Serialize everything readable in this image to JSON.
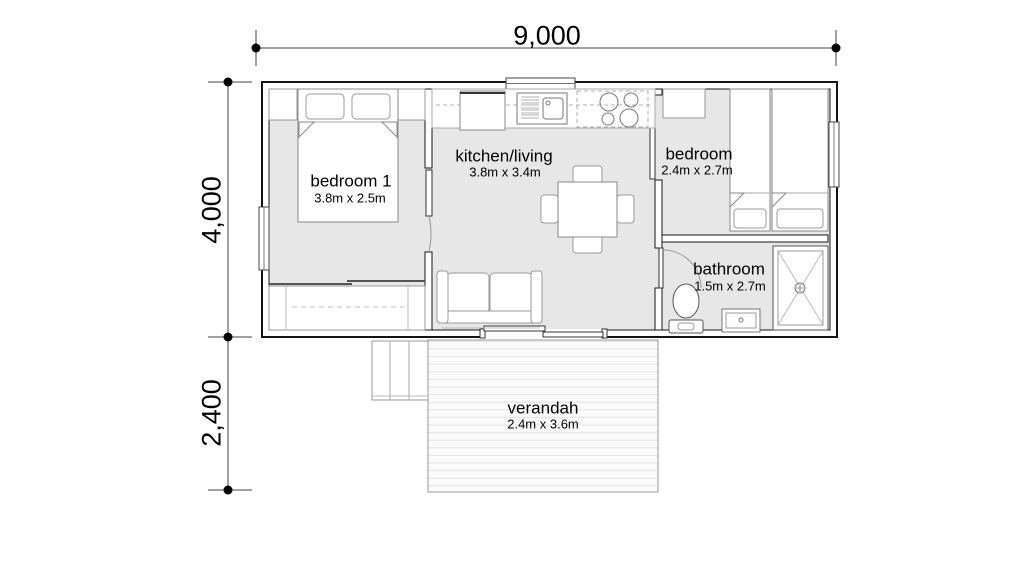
{
  "dimensions": {
    "width_total": "9,000",
    "height_main": "4,000",
    "height_verandah": "2,400"
  },
  "rooms": {
    "bedroom1": {
      "name": "bedroom 1",
      "size": "3.8m x 2.5m"
    },
    "kitchen_living": {
      "name": "kitchen/living",
      "size": "3.8m x 3.4m"
    },
    "bedroom2": {
      "name": "bedroom",
      "size": "2.4m x 2.7m"
    },
    "bathroom": {
      "name": "bathroom",
      "size": "1.5m x 2.7m"
    },
    "verandah": {
      "name": "verandah",
      "size": "2.4m x 3.6m"
    }
  },
  "colors": {
    "background": "#ffffff",
    "wall": "#141414",
    "floor": "#e7e7e7",
    "furniture_stroke": "#888888",
    "deck_stripe": "#e3e3e3",
    "dimension_line": "#444444"
  }
}
